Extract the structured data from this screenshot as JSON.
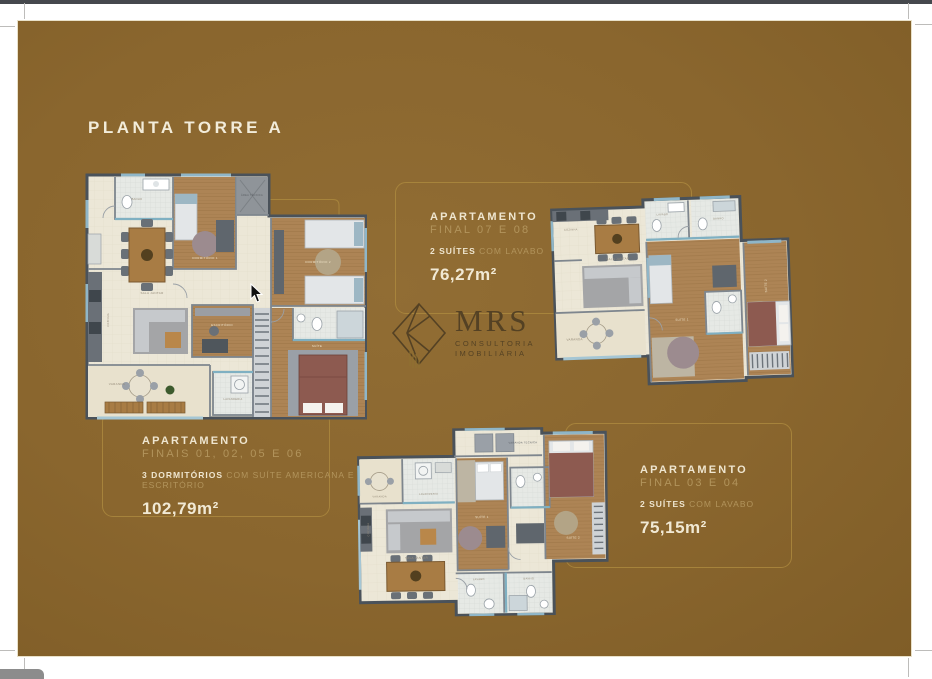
{
  "page": {
    "title": "PLANTA TORRE A",
    "background_color": "#8a662e",
    "accent_line_color": "#ab883e",
    "heading_text_color": "#efe6d0",
    "secondary_text_color": "#b2945c"
  },
  "logo": {
    "name": "MRS",
    "subtitle_line1": "CONSULTORIA",
    "subtitle_line2": "IMOBILIÁRIA"
  },
  "apartments": {
    "top_center": {
      "heading": "APARTAMENTO",
      "units": "FINAL 07 E 08",
      "feature_bold": "2 SUÍTES",
      "feature_rest": "COM LAVABO",
      "area": "76,27m²"
    },
    "bottom_left": {
      "heading": "APARTAMENTO",
      "units": "FINAIS 01, 02, 05 E 06",
      "feature_bold": "3 DORMITÓRIOS",
      "feature_rest": "COM SUÍTE AMERICANA E ESCRITÓRIO",
      "area": "102,79m²"
    },
    "bottom_right": {
      "heading": "APARTAMENTO",
      "units": "FINAL 03 E 04",
      "feature_bold": "2 SUÍTES",
      "feature_rest": "COM LAVABO",
      "area": "75,15m²"
    }
  },
  "floorplans": {
    "plan_a": {
      "rooms": {
        "sala": "SALA JANTAR",
        "dorm1": "DORMITÓRIO 1",
        "dorm2": "DORMITÓRIO 2",
        "suite": "SUÍTE",
        "escritorio": "ESCRITÓRIO",
        "cozinha": "COZINHA",
        "varanda": "VARANDA",
        "lavanderia": "LAVANDERIA",
        "banho": "BANHO",
        "area_tecnica": "ÁREA TÉCNICA"
      }
    },
    "plan_b": {
      "rooms": {
        "sala": "SALA JANTAR",
        "cozinha": "COZINHA",
        "varanda": "VARANDA",
        "suite1": "SUÍTE 1",
        "suite2": "SUÍTE 2",
        "banho": "BANHO",
        "lavabo": "LAVABO"
      }
    },
    "plan_c": {
      "rooms": {
        "sala": "SALA JANTAR",
        "cozinha": "COZINHA",
        "varanda": "VARANDA",
        "lavanderia": "LAVANDERIA",
        "varanda_tecnica": "VARANDA TÉCNICA",
        "suite1": "SUÍTE 1",
        "suite2": "SUÍTE 2",
        "banho": "BANHO",
        "lavabo": "LAVABO"
      }
    }
  }
}
